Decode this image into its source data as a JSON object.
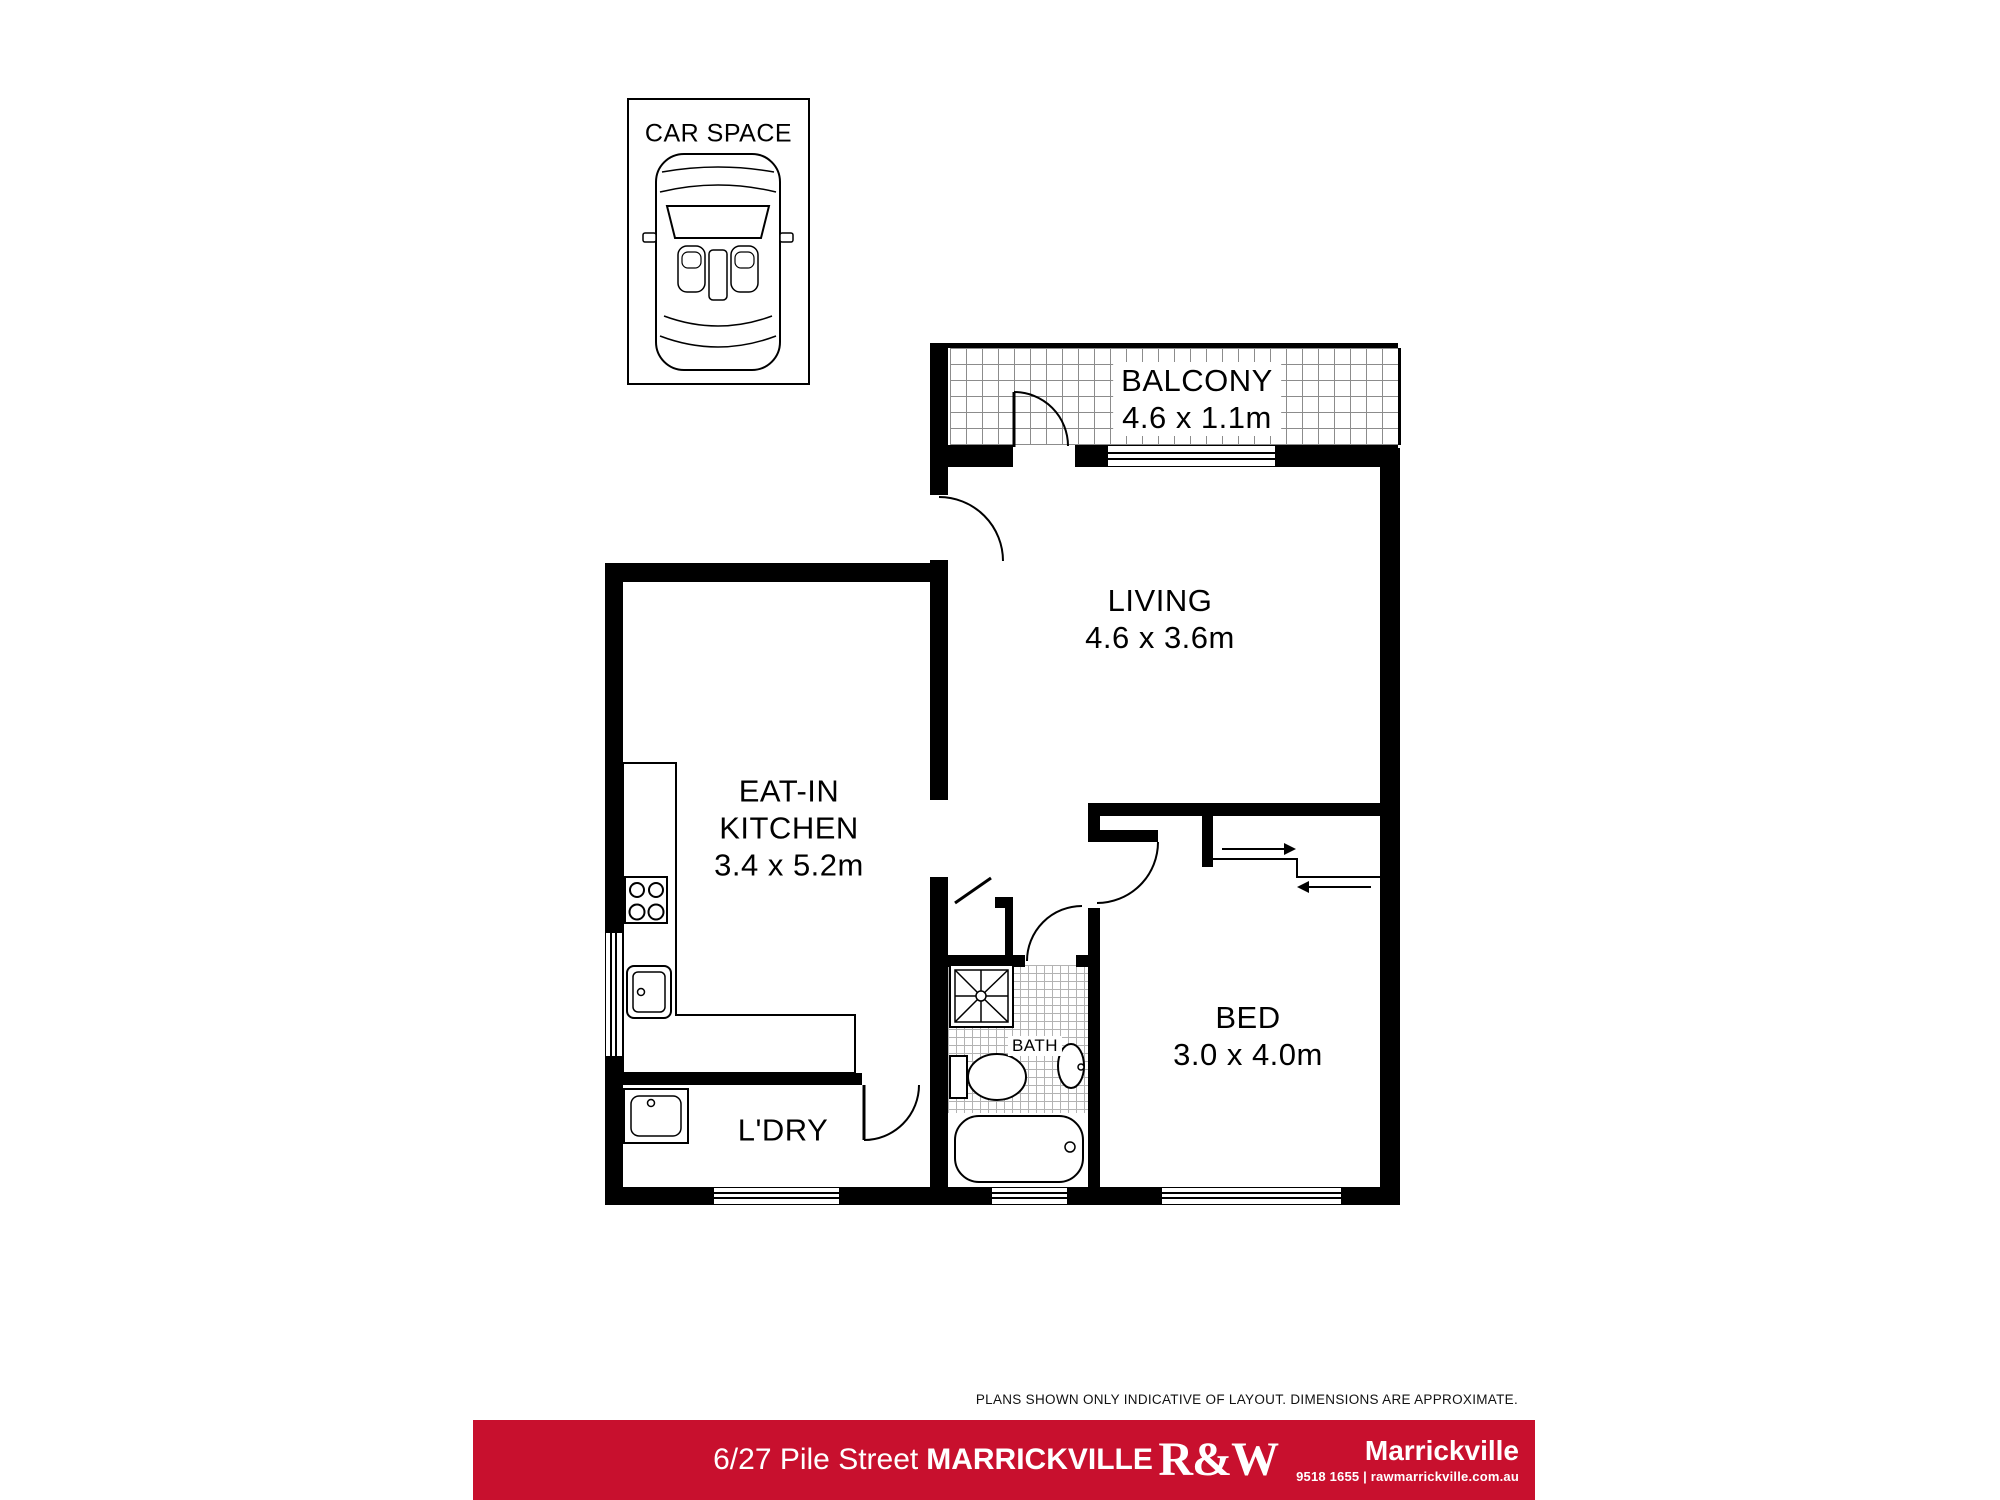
{
  "plan": {
    "car_space_label": "CAR SPACE",
    "balcony": {
      "name": "BALCONY",
      "dims": "4.6 x 1.1m"
    },
    "living": {
      "name": "LIVING",
      "dims": "4.6 x 3.6m"
    },
    "kitchen": {
      "line1": "EAT-IN",
      "line2": "KITCHEN",
      "dims": "3.4 x 5.2m"
    },
    "bed": {
      "name": "BED",
      "dims": "3.0 x 4.0m"
    },
    "bath": {
      "name": "BATH"
    },
    "laundry": {
      "name": "L'DRY"
    }
  },
  "footer": {
    "disclaimer": "PLANS SHOWN ONLY INDICATIVE OF LAYOUT. DIMENSIONS ARE APPROXIMATE.",
    "address_street": "6/27 Pile Street",
    "address_suburb": "MARRICKVILLE",
    "bar_color": "#c8102e",
    "brand": {
      "logo": "R&W",
      "office": "Marrickville",
      "contact": "9518 1655 | rawmarrickville.com.au"
    }
  }
}
